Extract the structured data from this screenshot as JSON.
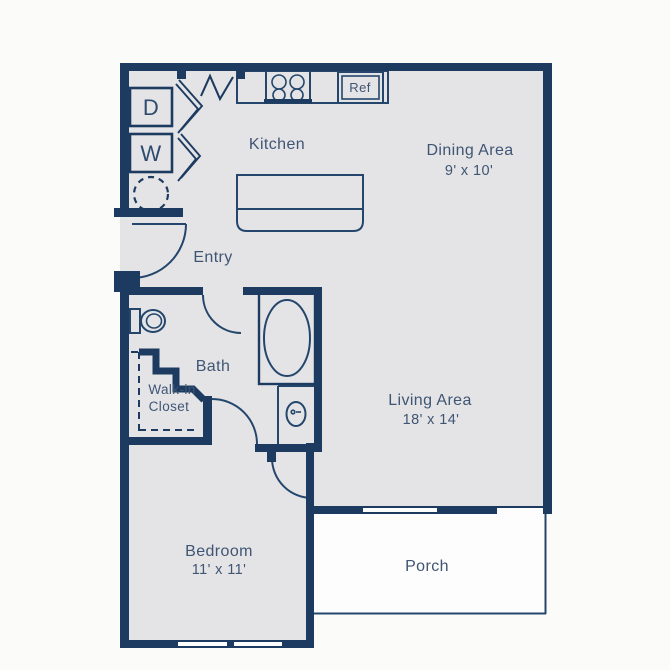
{
  "floorplan": {
    "rooms": {
      "kitchen": {
        "label": "Kitchen"
      },
      "dining": {
        "label": "Dining Area",
        "dims": "9' x 10'"
      },
      "living": {
        "label": "Living Area",
        "dims": "18' x 14'"
      },
      "bedroom": {
        "label": "Bedroom",
        "dims": "11' x 11'"
      },
      "bath": {
        "label": "Bath"
      },
      "closet": {
        "label_line1": "Walk-in",
        "label_line2": "Closet"
      },
      "entry": {
        "label": "Entry"
      },
      "porch": {
        "label": "Porch"
      }
    },
    "appliances": {
      "dryer": "D",
      "washer": "W",
      "fridge": "Ref"
    },
    "colors": {
      "wall": "#1d3b60",
      "text": "#3f5574",
      "floor": "#e4e4e6",
      "background": "#fbfbfa"
    }
  }
}
